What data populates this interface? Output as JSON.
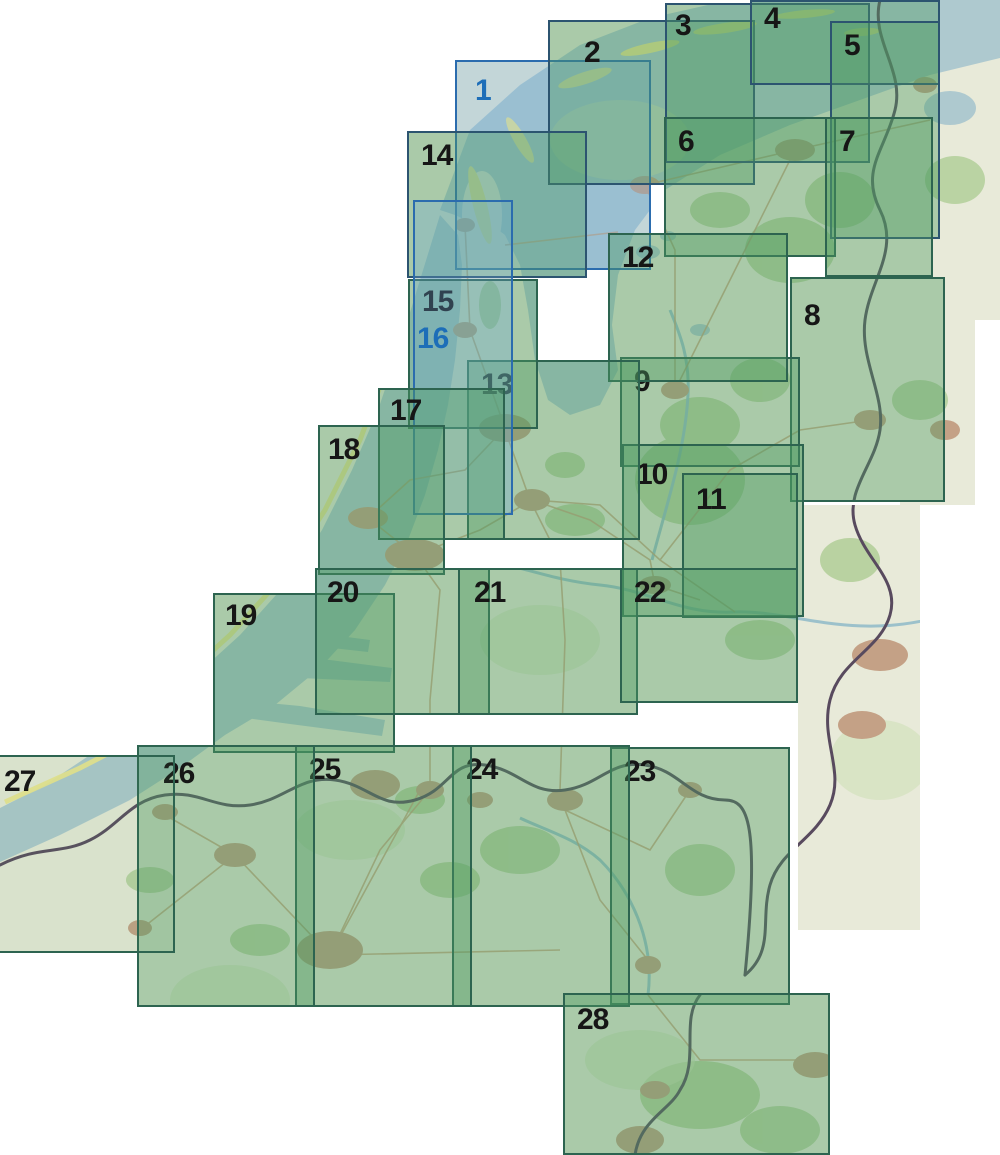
{
  "map": {
    "type": "sheet-index-map",
    "region_hint": "Netherlands and Flanders topographic sheet index",
    "colors": {
      "land": "#e8ead9",
      "sea": "#aec9cf",
      "forest": "#b5d09c",
      "forest_light": "#cfe0b8",
      "town": "#c4a186",
      "road": "#c6a37e",
      "river": "#93bcc9",
      "border": "#584a5e",
      "dune": "#ece791",
      "sheet_fill": "rgba(77,154,98,0.40)",
      "sheet_stroke": "#2d6450",
      "sheet_label": "#161616",
      "sea_fill": "rgba(110,170,215,0.30)",
      "sea_stroke": "#2b6cae",
      "sea_label": "#1d6eb8",
      "navy_stroke": "#2c5470"
    },
    "map_extent_patches": [
      {
        "x": 888,
        "y": 0,
        "w": 112,
        "h": 320
      },
      {
        "x": 900,
        "y": 320,
        "w": 75,
        "h": 185
      },
      {
        "x": 798,
        "y": 505,
        "w": 122,
        "h": 425
      }
    ],
    "sheets": [
      {
        "label": "1",
        "variant": "sea",
        "x": 455,
        "y": 60,
        "w": 196,
        "h": 210,
        "lx": 18,
        "ly": 14
      },
      {
        "label": "2",
        "variant": "navy",
        "x": 548,
        "y": 20,
        "w": 207,
        "h": 165,
        "lx": 34,
        "ly": 16
      },
      {
        "label": "3",
        "variant": "navy",
        "x": 665,
        "y": 3,
        "w": 205,
        "h": 160,
        "lx": 8,
        "ly": 6
      },
      {
        "label": "4",
        "variant": "navy",
        "x": 750,
        "y": 0,
        "w": 190,
        "h": 85,
        "lx": 12,
        "ly": 2
      },
      {
        "label": "5",
        "variant": "navy",
        "x": 830,
        "y": 21,
        "w": 110,
        "h": 218,
        "lx": 12,
        "ly": 8
      },
      {
        "label": "6",
        "variant": "land",
        "x": 664,
        "y": 117,
        "w": 172,
        "h": 140,
        "lx": 12,
        "ly": 8
      },
      {
        "label": "7",
        "variant": "land",
        "x": 825,
        "y": 117,
        "w": 108,
        "h": 160,
        "lx": 12,
        "ly": 8
      },
      {
        "label": "8",
        "variant": "land",
        "x": 790,
        "y": 277,
        "w": 155,
        "h": 225,
        "lx": 12,
        "ly": 22
      },
      {
        "label": "9",
        "variant": "land",
        "x": 620,
        "y": 357,
        "w": 180,
        "h": 110,
        "lx": 12,
        "ly": 8
      },
      {
        "label": "10",
        "variant": "land",
        "x": 622,
        "y": 444,
        "w": 182,
        "h": 173,
        "lx": 12,
        "ly": 14
      },
      {
        "label": "11",
        "variant": "land",
        "x": 682,
        "y": 473,
        "w": 116,
        "h": 145,
        "lx": 12,
        "ly": 10
      },
      {
        "label": "12",
        "variant": "land",
        "x": 608,
        "y": 233,
        "w": 180,
        "h": 149,
        "lx": 12,
        "ly": 8
      },
      {
        "label": "13",
        "variant": "land",
        "x": 467,
        "y": 360,
        "w": 173,
        "h": 180,
        "lx": 12,
        "ly": 8
      },
      {
        "label": "14",
        "variant": "navy",
        "x": 407,
        "y": 131,
        "w": 180,
        "h": 147,
        "lx": 12,
        "ly": 8
      },
      {
        "label": "15",
        "variant": "land",
        "x": 408,
        "y": 279,
        "w": 130,
        "h": 150,
        "lx": 12,
        "ly": 6
      },
      {
        "label": "16",
        "variant": "sea",
        "x": 413,
        "y": 200,
        "w": 100,
        "h": 315,
        "lx": 2,
        "ly": 122
      },
      {
        "label": "17",
        "variant": "land",
        "x": 378,
        "y": 388,
        "w": 127,
        "h": 152,
        "lx": 10,
        "ly": 6
      },
      {
        "label": "18",
        "variant": "land",
        "x": 318,
        "y": 425,
        "w": 127,
        "h": 150,
        "lx": 8,
        "ly": 8
      },
      {
        "label": "19",
        "variant": "land",
        "x": 213,
        "y": 593,
        "w": 182,
        "h": 160,
        "lx": 10,
        "ly": 6
      },
      {
        "label": "20",
        "variant": "land",
        "x": 315,
        "y": 568,
        "w": 175,
        "h": 147,
        "lx": 10,
        "ly": 8
      },
      {
        "label": "21",
        "variant": "land",
        "x": 458,
        "y": 568,
        "w": 180,
        "h": 147,
        "lx": 14,
        "ly": 8
      },
      {
        "label": "22",
        "variant": "land",
        "x": 620,
        "y": 568,
        "w": 178,
        "h": 135,
        "lx": 12,
        "ly": 8
      },
      {
        "label": "23",
        "variant": "land",
        "x": 610,
        "y": 747,
        "w": 180,
        "h": 258,
        "lx": 12,
        "ly": 8
      },
      {
        "label": "24",
        "variant": "land",
        "x": 452,
        "y": 745,
        "w": 178,
        "h": 262,
        "lx": 12,
        "ly": 8
      },
      {
        "label": "25",
        "variant": "land",
        "x": 295,
        "y": 745,
        "w": 177,
        "h": 262,
        "lx": 12,
        "ly": 8
      },
      {
        "label": "26",
        "variant": "land",
        "x": 137,
        "y": 745,
        "w": 178,
        "h": 262,
        "lx": 24,
        "ly": 12
      },
      {
        "label": "27",
        "variant": "land",
        "x": -18,
        "y": 755,
        "w": 193,
        "h": 198,
        "lx": 20,
        "ly": 10,
        "fill": "rgba(90,160,100,0.10)"
      },
      {
        "label": "28",
        "variant": "land",
        "x": 563,
        "y": 993,
        "w": 267,
        "h": 162,
        "lx": 12,
        "ly": 10
      }
    ]
  }
}
